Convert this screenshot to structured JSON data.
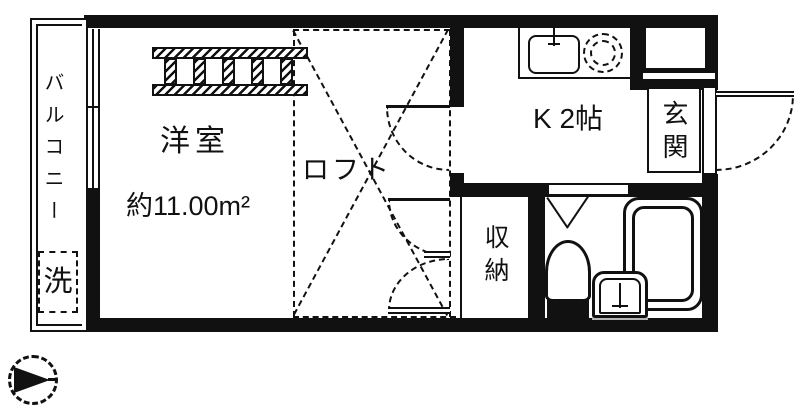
{
  "plan": {
    "type": "apartment-floor-plan",
    "colors": {
      "line": "#111111",
      "background": "#ffffff",
      "fixture_gray": "#b5b5b5"
    },
    "labels": {
      "balcony": "バルコニー",
      "washer": "洗",
      "room": "洋室",
      "room_area": "約11.00m²",
      "loft": "ロフト",
      "kitchen": "K 2帖",
      "entrance": "玄関",
      "storage": "収納"
    },
    "fixtures": {
      "ladder": "loft-ladder",
      "sink": "kitchen-sink",
      "burner": "stove-burner",
      "toilet": "toilet",
      "bathtub": "bathtub",
      "vanity": "vanity-sink",
      "front_door": "entrance-door",
      "compass": "north-arrow"
    }
  }
}
